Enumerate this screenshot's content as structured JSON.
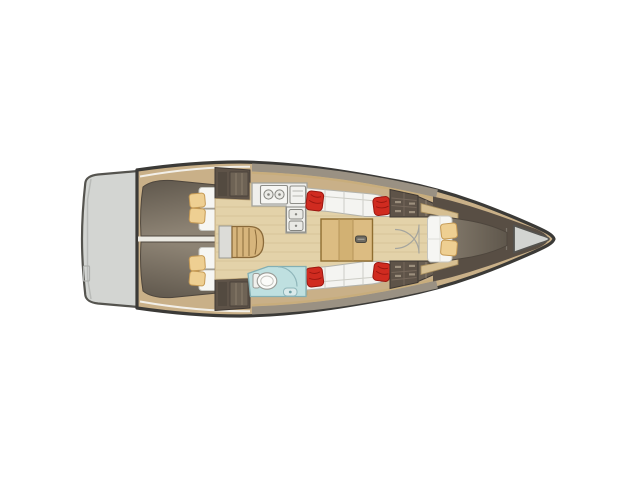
{
  "figure": {
    "kind": "sailing-yacht-interior-layout-plan",
    "view": "top view, bow to the right, stern to the left",
    "width_px": 640,
    "height_px": 480,
    "background": "#ffffff"
  },
  "colors": {
    "background": "#ffffff",
    "hull_outline": "#3b3a37",
    "deck_wood": "#c9b088",
    "transom_gray": "#d3d5d2",
    "coachroof_band": "#9a9183",
    "coachroof_trim": "#c8ad7c",
    "berth_dark": "#5f574c",
    "berth_light": "#8d8374",
    "mattress_white": "#f6f6f3",
    "cushion_tan": "#eecf92",
    "cushion_red": "#d02b20",
    "floor_wood": "#e3d2a9",
    "steps_wood": "#d7b57c",
    "table_wood": "#dcbc82",
    "counter_white": "#efefec",
    "head_floor": "#bfe0e0",
    "cabinet_brown": "#5e5348",
    "cabinet_brown_light": "#6a5f52",
    "fore_walls": "#584e44",
    "anchor_locker": "#d2d4d1"
  },
  "regions": {
    "swim_platform": {
      "label": "Stern swim platform / transom"
    },
    "aft_cabin_top": {
      "label": "Aft double cabin (port)",
      "white_pillows": 2,
      "tan_cushions": 2
    },
    "aft_cabin_bottom": {
      "label": "Aft double cabin (starboard)",
      "white_pillows": 2,
      "tan_cushions": 2
    },
    "companionway": {
      "label": "Companionway steps"
    },
    "galley": {
      "label": "Galley with stove and twin sinks",
      "burners": 2,
      "sinks": 2
    },
    "saloon": {
      "label": "Saloon with facing settees",
      "red_cushions": 4
    },
    "table": {
      "label": "Folding saloon table"
    },
    "head": {
      "label": "Head with toilet and shower"
    },
    "wardrobes": {
      "label": "Wardrobes and lockers"
    },
    "fore_cabin": {
      "label": "Forward V-berth cabin",
      "tan_cushions": 2
    },
    "anchor_locker": {
      "label": "Bow anchor locker"
    }
  }
}
